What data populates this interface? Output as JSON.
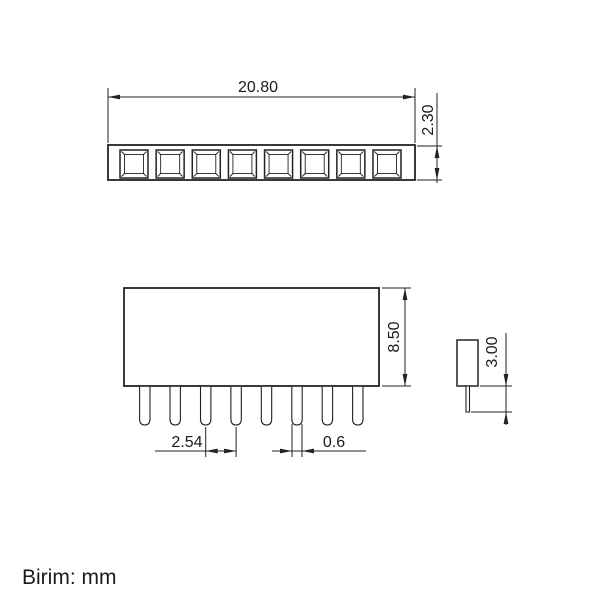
{
  "drawing": {
    "background": "#ffffff",
    "line_color": "#222222",
    "text_color": "#1a1a1a",
    "unit_note": "Birim: mm",
    "views": {
      "top": {
        "socket_count": 8,
        "dimensions": {
          "width": "20.80",
          "height": "2.30"
        }
      },
      "front": {
        "pin_count": 8,
        "dimensions": {
          "body_height": "8.50",
          "pin_pitch": "2.54",
          "pin_width": "0.6"
        }
      },
      "side": {
        "dimensions": {
          "pin_length": "3.00"
        }
      }
    }
  }
}
